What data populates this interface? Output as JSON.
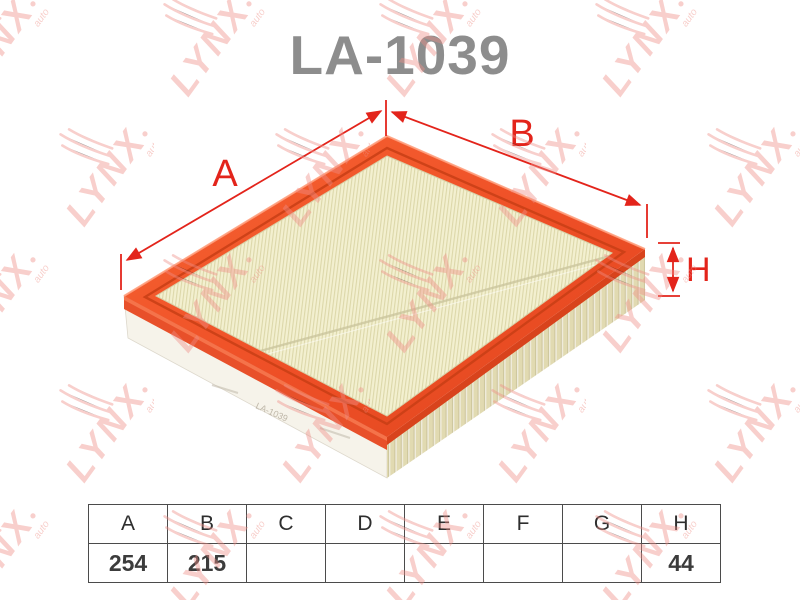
{
  "title": "LA-1039",
  "watermark": {
    "text": "LYNX",
    "suffix": "auto"
  },
  "diagram": {
    "labels": {
      "a": "A",
      "b": "B",
      "h": "H"
    },
    "side_stamp": "LA-1039",
    "colors": {
      "frame_orange": "#ef5128",
      "media_cream": "#f3f0d0",
      "dimension_red": "#e3241b",
      "title_gray": "#8d8d8d"
    }
  },
  "table": {
    "headers": [
      "A",
      "B",
      "C",
      "D",
      "E",
      "F",
      "G",
      "H"
    ],
    "values": [
      "254",
      "215",
      "",
      "",
      "",
      "",
      "",
      "44"
    ]
  }
}
